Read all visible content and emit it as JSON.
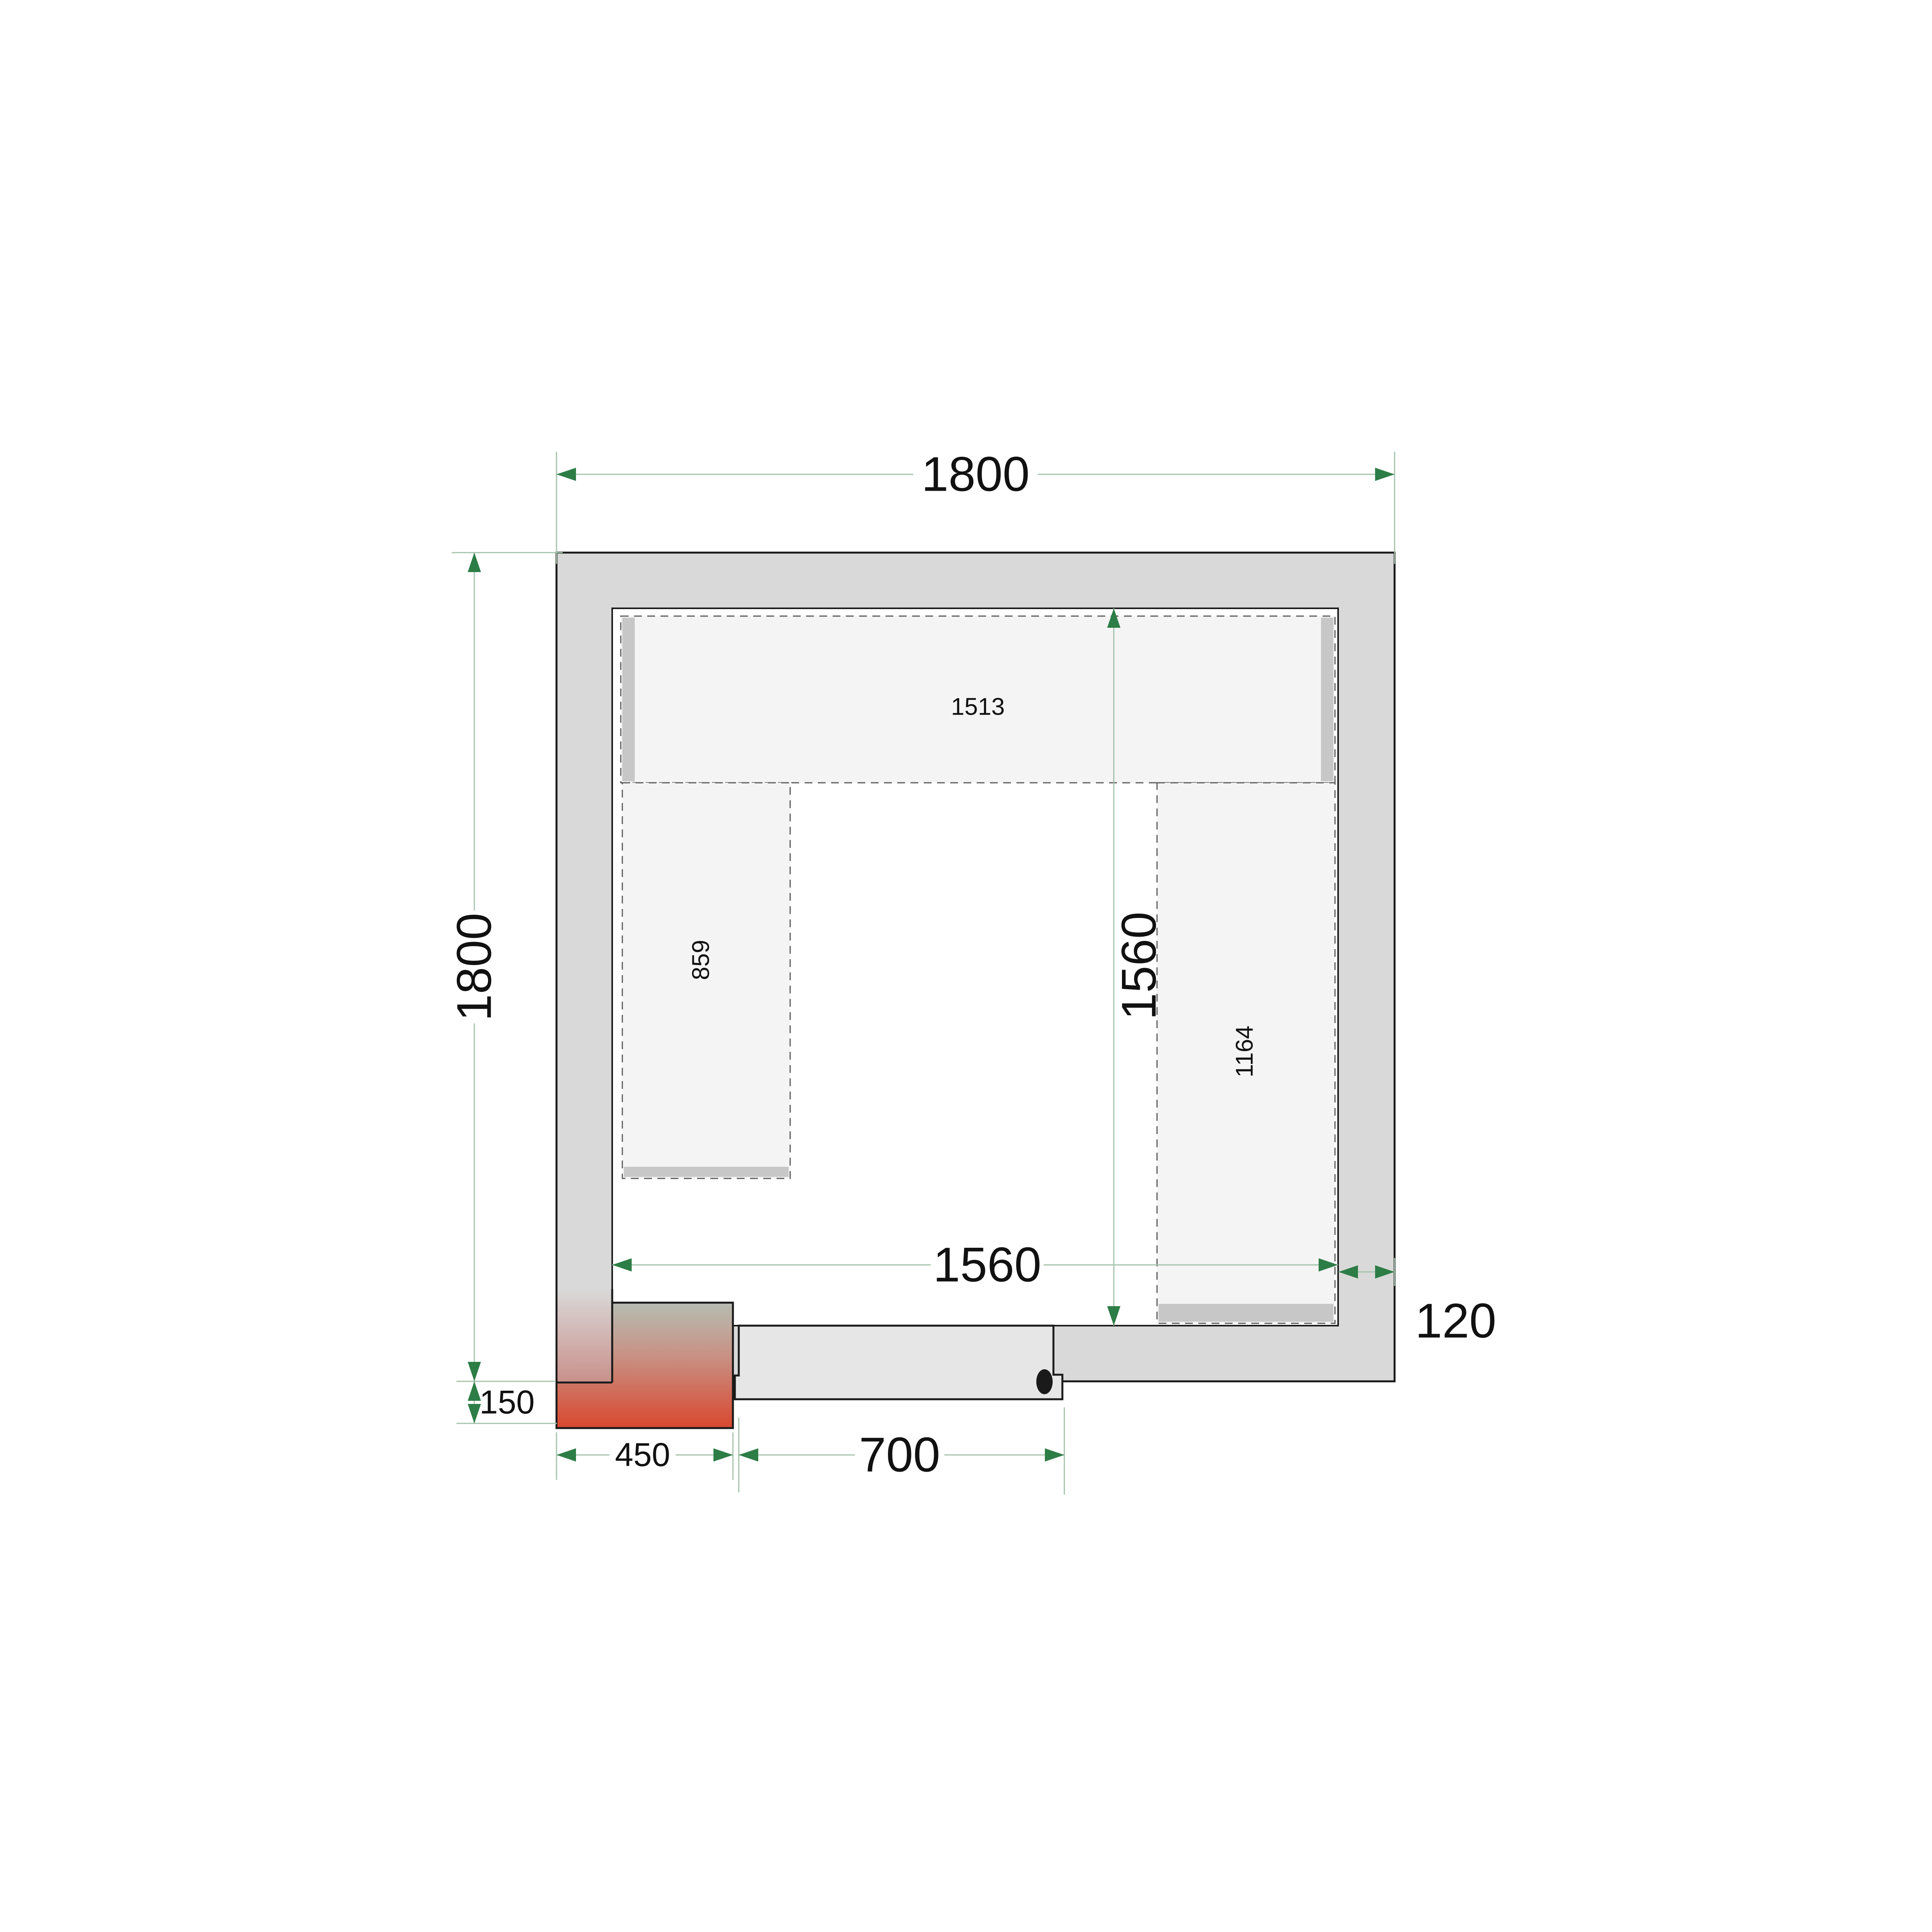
{
  "labels": {
    "outer_width": "1800",
    "outer_height": "1800",
    "inner_width": "1560",
    "inner_height": "1560",
    "wall_thickness": "120",
    "door_width": "700",
    "unit_width": "450",
    "unit_offset": "150",
    "shelf_top": "1513",
    "shelf_left": "859",
    "shelf_right": "1164"
  },
  "colors": {
    "dimension_green": "#2d7d46",
    "dimension_line": "#a3c2ab",
    "outline": "#1a1a1a",
    "wall_fill": "#d9d9d9",
    "door_fill": "#e6e6e6",
    "shelf_fill": "#f4f4f4",
    "shelf_strip": "#c7c7c7",
    "shelf_dash": "#5a5a5a",
    "unit_top": "#b7bdb3",
    "unit_mid": "#c98e80",
    "unit_bottom": "#d9482f",
    "overlay_top": "#d9d9d9",
    "overlay_bottom": "#c9908a"
  }
}
